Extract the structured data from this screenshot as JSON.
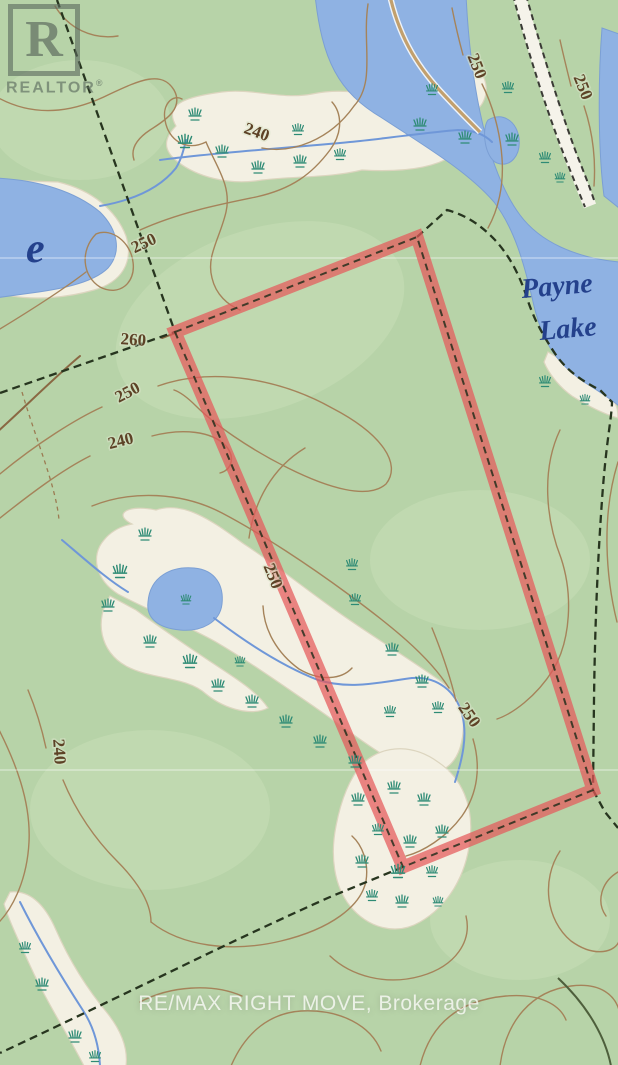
{
  "branding": {
    "logo_letter": "R",
    "logo_word": "REALTOR",
    "logo_reg": "®"
  },
  "watermark": {
    "text": "RE/MAX RIGHT MOVE, Brokerage"
  },
  "map": {
    "labels": {
      "lake_right_line1": "Payne",
      "lake_right_line2": "Lake",
      "lake_left_partial": "e"
    },
    "contour_labels": [
      {
        "text": "240",
        "x": 255,
        "y": 137,
        "rot": 20
      },
      {
        "text": "250",
        "x": 146,
        "y": 248,
        "rot": -25
      },
      {
        "text": "260",
        "x": 133,
        "y": 345,
        "rot": 4
      },
      {
        "text": "250",
        "x": 130,
        "y": 397,
        "rot": -28
      },
      {
        "text": "240",
        "x": 122,
        "y": 446,
        "rot": -14
      },
      {
        "text": "250",
        "x": 472,
        "y": 68,
        "rot": 68
      },
      {
        "text": "250",
        "x": 578,
        "y": 89,
        "rot": 68
      },
      {
        "text": "250",
        "x": 268,
        "y": 578,
        "rot": 68
      },
      {
        "text": "250",
        "x": 465,
        "y": 718,
        "rot": 55
      },
      {
        "text": "240",
        "x": 54,
        "y": 752,
        "rot": 86
      }
    ],
    "colors": {
      "land": "#b7d3a8",
      "water": "#8fb2e3",
      "wetland": "#f3f0e3",
      "contour": "#a5835a",
      "marsh": "#2e8b75",
      "stream": "#6f97d8",
      "parcel_highlight": "#e4595a",
      "boundary": "#27351f",
      "contour_label": "#5d4226",
      "lake_label": "#24418c"
    }
  }
}
